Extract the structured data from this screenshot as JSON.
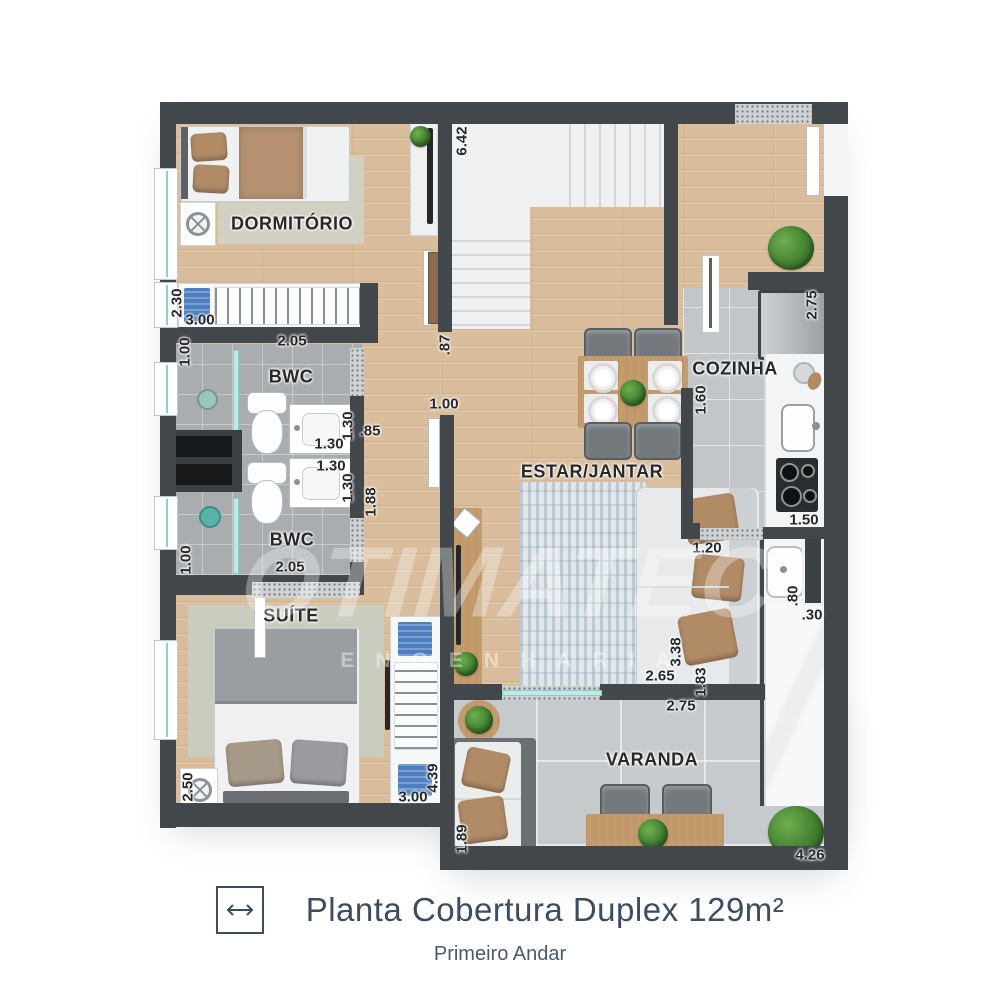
{
  "plan": {
    "watermark": {
      "word": "OTIMATEC",
      "sub": "ENGENHARIA"
    },
    "rooms": {
      "dormitorio": "DORMITÓRIO",
      "bwc_top": "BWC",
      "bwc_bottom": "BWC",
      "suite": "SUÍTE",
      "estar_jantar": "ESTAR/JANTAR",
      "cozinha": "COZINHA",
      "varanda": "VARANDA"
    },
    "measurements": {
      "stairs_height": "6.42",
      "stairs_exit": ".87",
      "dorm_wardrobe_depth": "2.30",
      "dorm_wardrobe_width": "3.00",
      "bwc_top_left": "1.00",
      "bwc_top_width": "2.05",
      "sink_top_height": "1.30",
      "sink_top_width": "1.30",
      "hall_door_top": ".85",
      "sink_bottom_width": "1.30",
      "sink_bottom_height": "1.30",
      "hall_door_bottom": "1.88",
      "bwc_bottom_width": "2.05",
      "bwc_bottom_left": "1.00",
      "estar_door": "1.00",
      "suite_fan_side": "2.50",
      "suite_wardrobe_height": "4.39",
      "suite_wardrobe_width": "3.00",
      "fridge_side": "2.75",
      "cozinha_width": "1.60",
      "stove_width": "1.50",
      "varanda_door": "1.20",
      "tub_height": ".80",
      "tub_side": ".30",
      "sofa_width": "2.65",
      "sofa_height": "3.38",
      "varanda_side": "1.83",
      "varanda_top": "2.75",
      "varanda_sofa_side": "1.89",
      "varanda_width": "4.26"
    }
  },
  "caption": {
    "title": "Planta Cobertura Duplex 129m²",
    "subtitle": "Primeiro Andar"
  },
  "colors": {
    "wall": "#42474b",
    "wood": "#d9bd9c",
    "tile_bath": "#a9adb0",
    "tile_kitchen": "#c3c6c8",
    "tile_varanda": "#c7cacc",
    "glass_accent": "#8fd2c9",
    "blue_accent": "#4d7fc0",
    "title_text": "#3d4c61"
  }
}
